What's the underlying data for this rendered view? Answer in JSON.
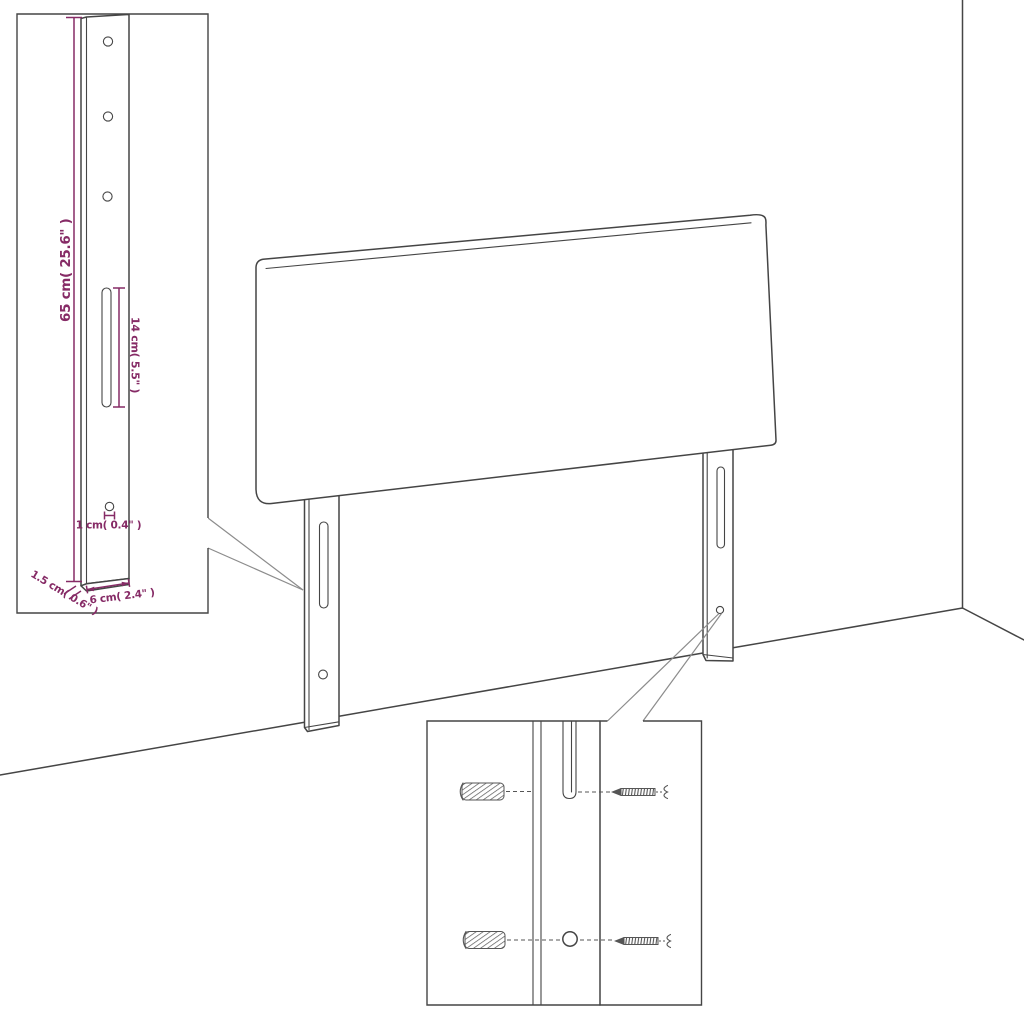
{
  "diagram": {
    "type": "furniture-assembly-dimension-diagram",
    "subject": "upholstered headboard with two mounting legs in a room corner",
    "background": "#ffffff",
    "colors": {
      "outline": "#454545",
      "dimension": "#862b66",
      "callout": "#8c8c8c",
      "hardware": "#555555"
    },
    "insets": {
      "bracket_detail": {
        "name": "leg-dimension-detail",
        "dimensions": {
          "height_label": "65 cm( 25.6\" )",
          "slot_label": "14 cm( 5.5\" )",
          "hole_label": "1 cm( 0.4\" )",
          "thickness_label": "1.5 cm( 0.6\" )",
          "width_label": "6 cm( 2.4\" )"
        }
      },
      "mounting_detail": {
        "name": "wall-mounting-detail",
        "hardware": [
          "wall-plug",
          "screw",
          "wall-plug",
          "screw"
        ]
      }
    }
  }
}
